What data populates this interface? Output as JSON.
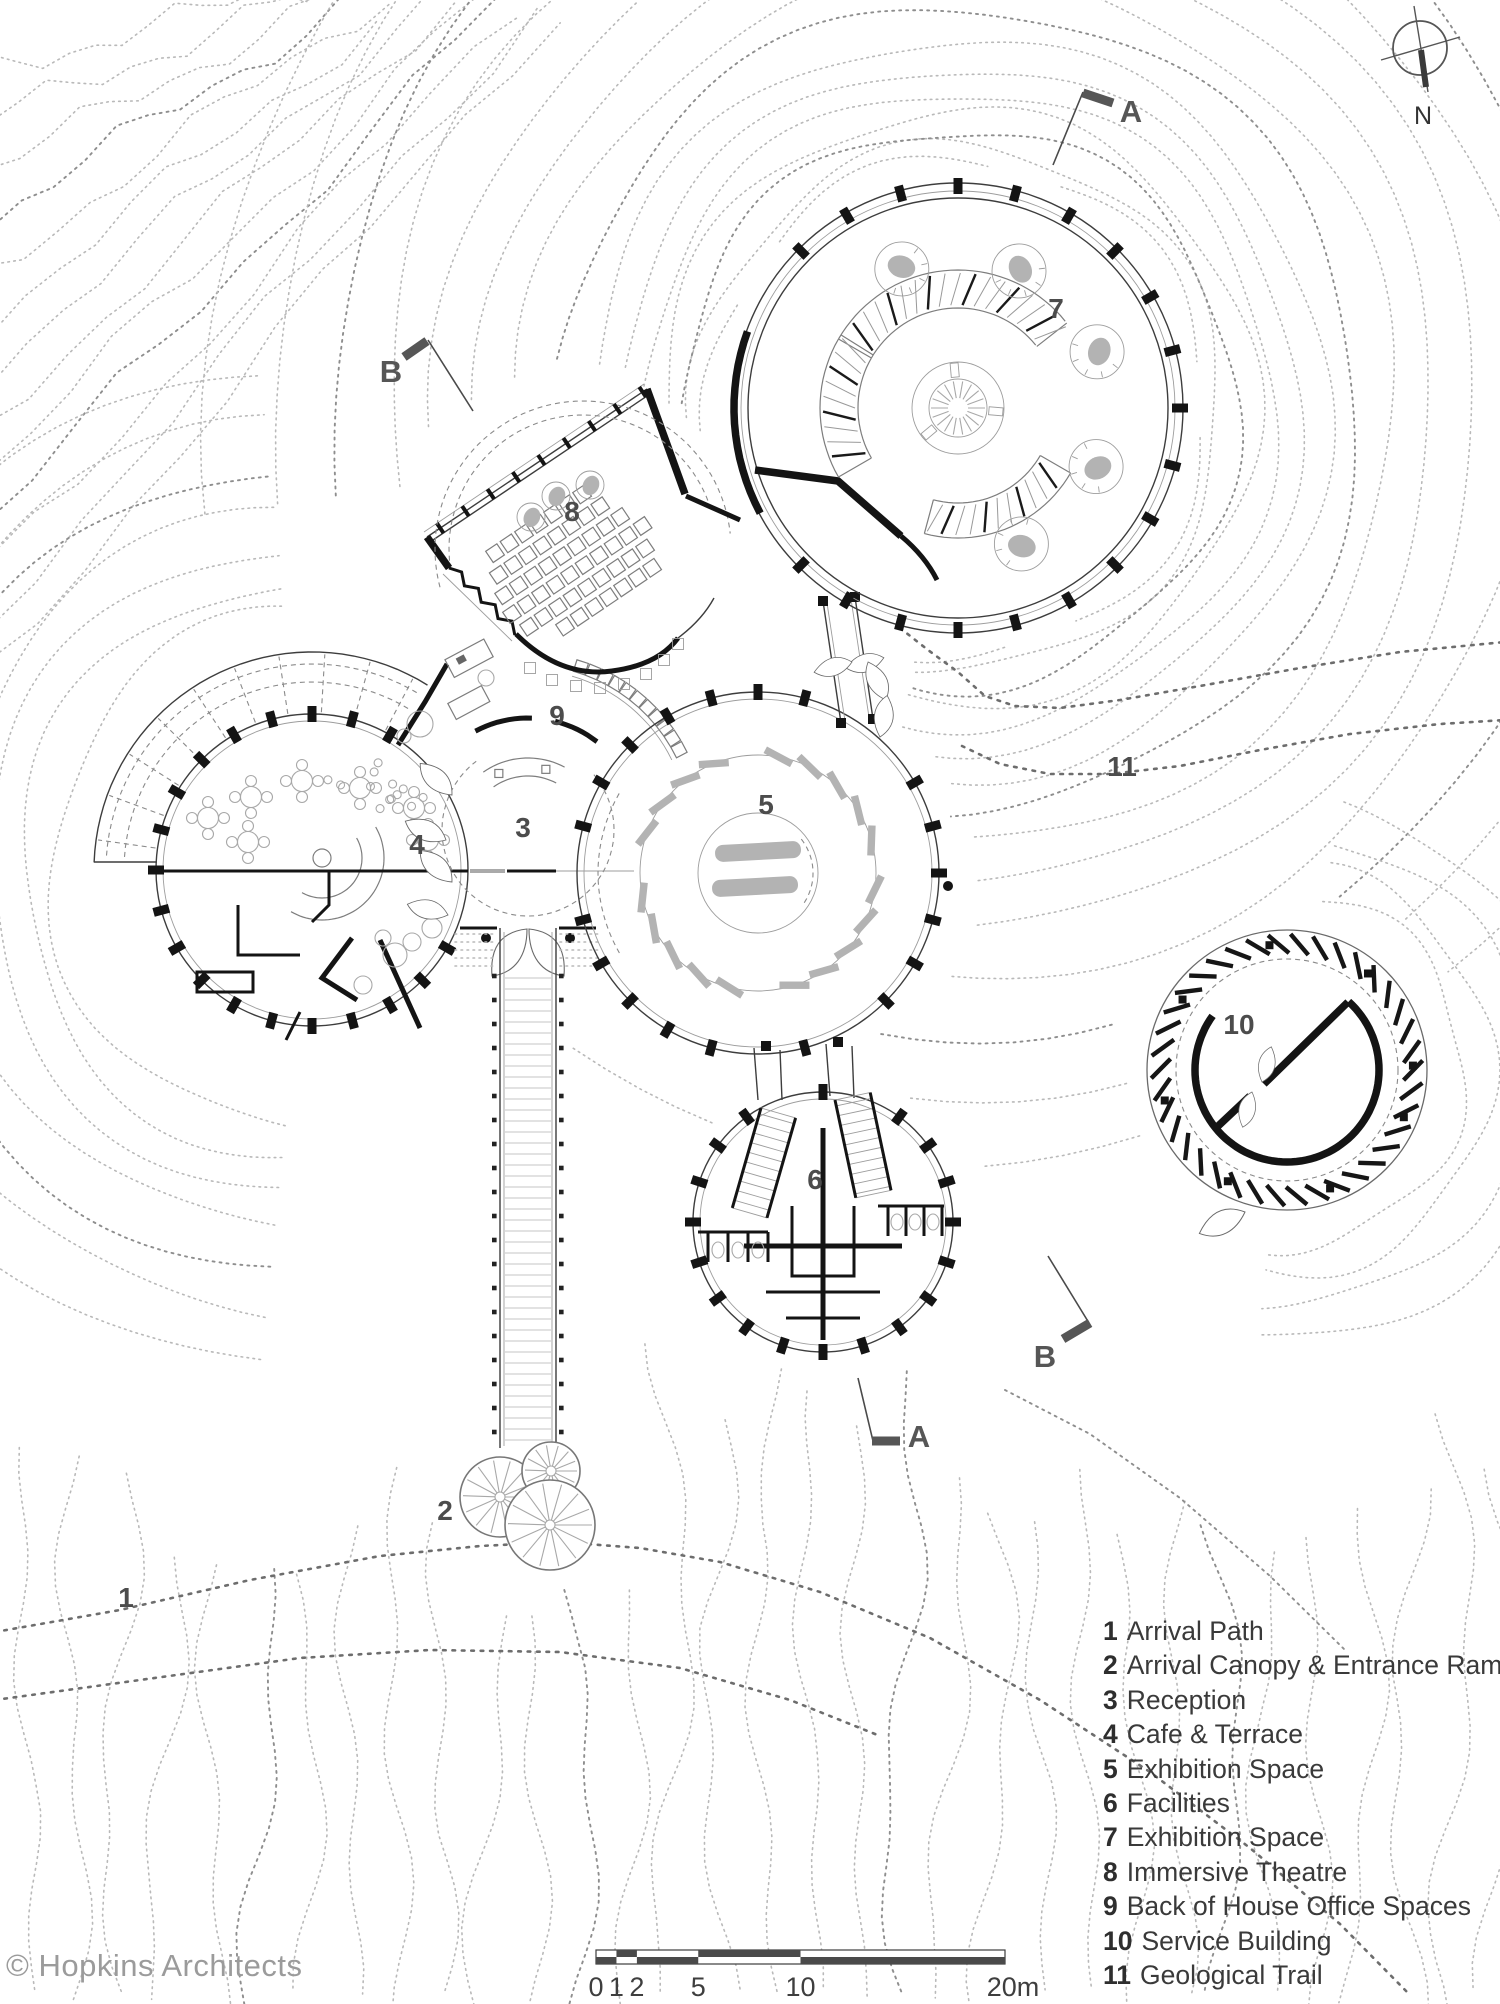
{
  "plan": {
    "labels": {
      "l1": "1",
      "l2": "2",
      "l3": "3",
      "l4": "4",
      "l5": "5",
      "l6": "6",
      "l7": "7",
      "l8": "8",
      "l9": "9",
      "l10": "10",
      "l11": "11"
    },
    "markers": {
      "a_top": "A",
      "b_left": "B",
      "b_right": "B",
      "a_bottom": "A"
    },
    "north": "N"
  },
  "legend": {
    "items": [
      {
        "num": "1",
        "label": "Arrival Path"
      },
      {
        "num": "2",
        "label": "Arrival Canopy & Entrance Ramp"
      },
      {
        "num": "3",
        "label": "Reception"
      },
      {
        "num": "4",
        "label": "Cafe & Terrace"
      },
      {
        "num": "5",
        "label": "Exhibition Space"
      },
      {
        "num": "6",
        "label": "Facilities"
      },
      {
        "num": "7",
        "label": "Exhibition Space"
      },
      {
        "num": "8",
        "label": "Immersive Theatre"
      },
      {
        "num": "9",
        "label": "Back of House Office Spaces"
      },
      {
        "num": "10",
        "label": "Service Building"
      },
      {
        "num": "11",
        "label": "Geological Trail"
      }
    ]
  },
  "scale_bar": {
    "labels": [
      "0",
      "1",
      "2",
      "5",
      "10",
      "20m"
    ],
    "meters": [
      0,
      1,
      2,
      5,
      10,
      20
    ]
  },
  "copyright": "© Hopkins Architects"
}
